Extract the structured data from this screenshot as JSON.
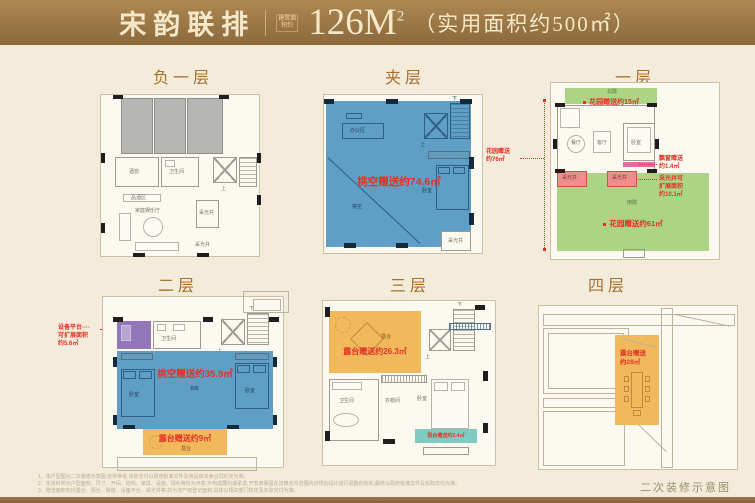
{
  "header": {
    "brand": "宋韵联排",
    "area_tag": "建筑面积约",
    "area_value": "126M",
    "area_sup": "2",
    "usable": "（实用面积约500㎡）"
  },
  "colors": {
    "bar_brown": "#9a7747",
    "accent_red": "#e23226",
    "blue": "#5f9fc5",
    "green": "#abd584",
    "orange": "#f1b85c",
    "teal": "#7fcbc2",
    "purple": "#9377bb",
    "pink": "#ee8d8d"
  },
  "floors": {
    "b1": {
      "title": "负一层",
      "labels": {
        "wine": "酒窖",
        "bath": "卫生间",
        "tasting": "品酒区",
        "family": "家庭娱乐厅",
        "well_box": "采光井",
        "well": "采光井",
        "up": "上"
      }
    },
    "mezz": {
      "title": "夹层",
      "gift": "挑空赠送约74.6㎡",
      "labels": {
        "office": "办公区",
        "void": "挑空",
        "bed": "卧室",
        "well": "采光井",
        "up": "上",
        "down": "下"
      }
    },
    "f1": {
      "title": "一层",
      "garden_top": "花园赠送约15㎡",
      "garden_bottom": "花园赠送约61㎡",
      "garden_side_l1": "花园赠送",
      "garden_side_l2": "约76㎡",
      "ann_bay_l1": "飘窗赠送",
      "ann_bay_l2": "约1.4㎡",
      "ann_well_l1": "采光井可",
      "ann_well_l2": "扩展面积",
      "ann_well_l3": "约10.1㎡",
      "labels": {
        "north": "北院",
        "south": "南院",
        "dining": "餐厅",
        "living": "客厅",
        "bed": "卧室",
        "well1": "采光井",
        "well2": "采光井",
        "up": "上"
      }
    },
    "f2": {
      "title": "二层",
      "gift": "挑空赠送约35.9㎡",
      "terrace_gift": "露台赠送约9㎡",
      "ann_l1": "设备平台····",
      "ann_l2": "可扩展面积",
      "ann_l3": "约5.6㎡",
      "labels": {
        "bath": "卫生间",
        "bed1": "卧室",
        "study": "书房",
        "bed2": "卧室",
        "terrace": "露台",
        "up": "上",
        "down": "下"
      }
    },
    "f3": {
      "title": "三层",
      "gift": "露台赠送约26.3㎡",
      "balcony_gift": "阳台赠送约2.4㎡",
      "labels": {
        "terrace": "露台",
        "bath": "卫生间",
        "cloak": "衣帽间",
        "bed": "卧室",
        "up": "上",
        "down": "下"
      }
    },
    "f4": {
      "title": "四层",
      "gift_l1": "露台赠送",
      "gift_l2": "约28㎡"
    }
  },
  "footer": {
    "notes": [
      "1、本户型图为二次装修示意图,仅供参考,实际交付以政府批准文件及商品房买卖合同约定为准。",
      "2、本资料所示户型面积、尺寸、开间、结构、家具、设施、绿化等仅为示意,不构成要约或承诺,开发商保留在法律允许范围内对规划设计进行调整的权利,最终以政府核准文件及实际交付为准。",
      "3、赠送面积包括露台、阳台、飘窗、设备平台、采光井等,均为非产权登记面积,具体以相关部门核定及实际交付为准。"
    ],
    "caption": "二次装修示意图"
  }
}
